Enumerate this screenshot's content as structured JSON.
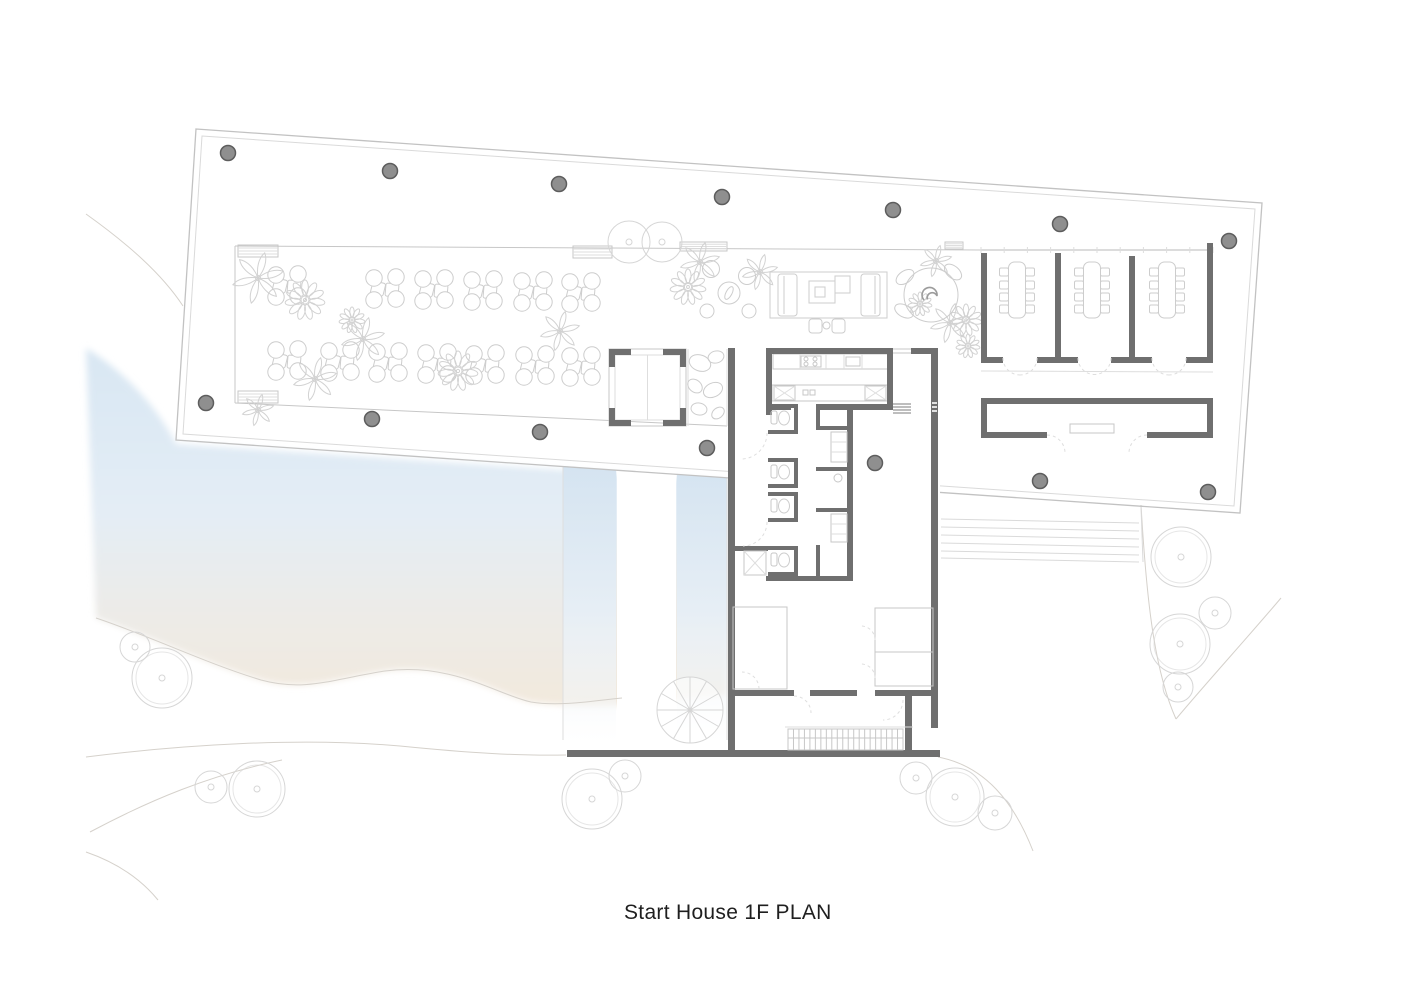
{
  "title": {
    "text": "Start House 1F PLAN"
  },
  "colors": {
    "wall": "#6f6f6f",
    "column_fill": "#8f8f8f",
    "column_stroke": "#5d5d5d",
    "line": "#c7c7c7",
    "line_faint": "#dedede",
    "furniture": "#cdcdcd",
    "terrain": "#d5d1cb",
    "tree": "#d6d6d6",
    "water_blue": "#d9e7f3",
    "water_mid": "#e6eef6",
    "sand": "#f2e9dd",
    "glyph": "#9c9c9c"
  },
  "plan": {
    "columns": [
      [
        228,
        153
      ],
      [
        390,
        171
      ],
      [
        559,
        184
      ],
      [
        722,
        197
      ],
      [
        893,
        210
      ],
      [
        1060,
        224
      ],
      [
        1229,
        241
      ],
      [
        206,
        403
      ],
      [
        372,
        419
      ],
      [
        540,
        432
      ],
      [
        707,
        448
      ],
      [
        875,
        463
      ],
      [
        1040,
        481
      ],
      [
        1208,
        492
      ]
    ],
    "trees": [
      [
        135,
        647,
        15
      ],
      [
        162,
        678,
        30
      ],
      [
        211,
        787,
        16
      ],
      [
        257,
        789,
        28
      ],
      [
        592,
        799,
        30
      ],
      [
        625,
        776,
        16
      ],
      [
        916,
        778,
        16
      ],
      [
        955,
        797,
        29
      ],
      [
        995,
        813,
        17
      ],
      [
        1181,
        557,
        30
      ],
      [
        1215,
        613,
        16
      ],
      [
        1180,
        644,
        30
      ],
      [
        1178,
        687,
        15
      ],
      [
        629,
        242,
        21
      ],
      [
        662,
        242,
        20
      ]
    ],
    "dining_tables": [
      [
        287,
        286
      ],
      [
        385,
        289
      ],
      [
        434,
        290
      ],
      [
        483,
        291
      ],
      [
        533,
        292
      ],
      [
        581,
        293
      ],
      [
        287,
        361
      ],
      [
        340,
        362
      ],
      [
        388,
        363
      ],
      [
        437,
        364
      ],
      [
        485,
        365
      ],
      [
        535,
        366
      ],
      [
        581,
        367
      ]
    ],
    "plants": [
      {
        "type": "palm",
        "x": 258,
        "y": 278,
        "s": 26
      },
      {
        "type": "palm",
        "x": 363,
        "y": 339,
        "s": 22
      },
      {
        "type": "palm",
        "x": 315,
        "y": 379,
        "s": 22
      },
      {
        "type": "palm",
        "x": 560,
        "y": 331,
        "s": 20
      },
      {
        "type": "palm",
        "x": 258,
        "y": 410,
        "s": 16
      },
      {
        "type": "palm",
        "x": 700,
        "y": 262,
        "s": 20
      },
      {
        "type": "palm",
        "x": 760,
        "y": 272,
        "s": 18
      },
      {
        "type": "palm",
        "x": 936,
        "y": 261,
        "s": 16
      },
      {
        "type": "palm",
        "x": 950,
        "y": 323,
        "s": 20
      },
      {
        "type": "daisy",
        "x": 305,
        "y": 300,
        "s": 20
      },
      {
        "type": "daisy",
        "x": 352,
        "y": 320,
        "s": 13
      },
      {
        "type": "daisy",
        "x": 458,
        "y": 371,
        "s": 20
      },
      {
        "type": "daisy",
        "x": 688,
        "y": 287,
        "s": 18
      },
      {
        "type": "daisy",
        "x": 966,
        "y": 320,
        "s": 16
      },
      {
        "type": "daisy",
        "x": 968,
        "y": 346,
        "s": 12
      },
      {
        "type": "daisy",
        "x": 920,
        "y": 304,
        "s": 12
      }
    ],
    "meeting_tables_x": [
      1017,
      1092,
      1167
    ],
    "meeting_chair_rows_y": [
      268,
      281,
      293,
      305
    ],
    "steps_right": {
      "x1": 941,
      "x2": 1139,
      "ys": [
        519,
        527,
        535,
        543,
        551,
        558
      ],
      "slope": 4
    },
    "stair_hatch": {
      "x": 788,
      "y": 729,
      "w": 115,
      "h": 21,
      "count": 21
    },
    "spiral_stair": {
      "x": 690,
      "y": 710,
      "r": 33,
      "spokes": 12
    }
  }
}
